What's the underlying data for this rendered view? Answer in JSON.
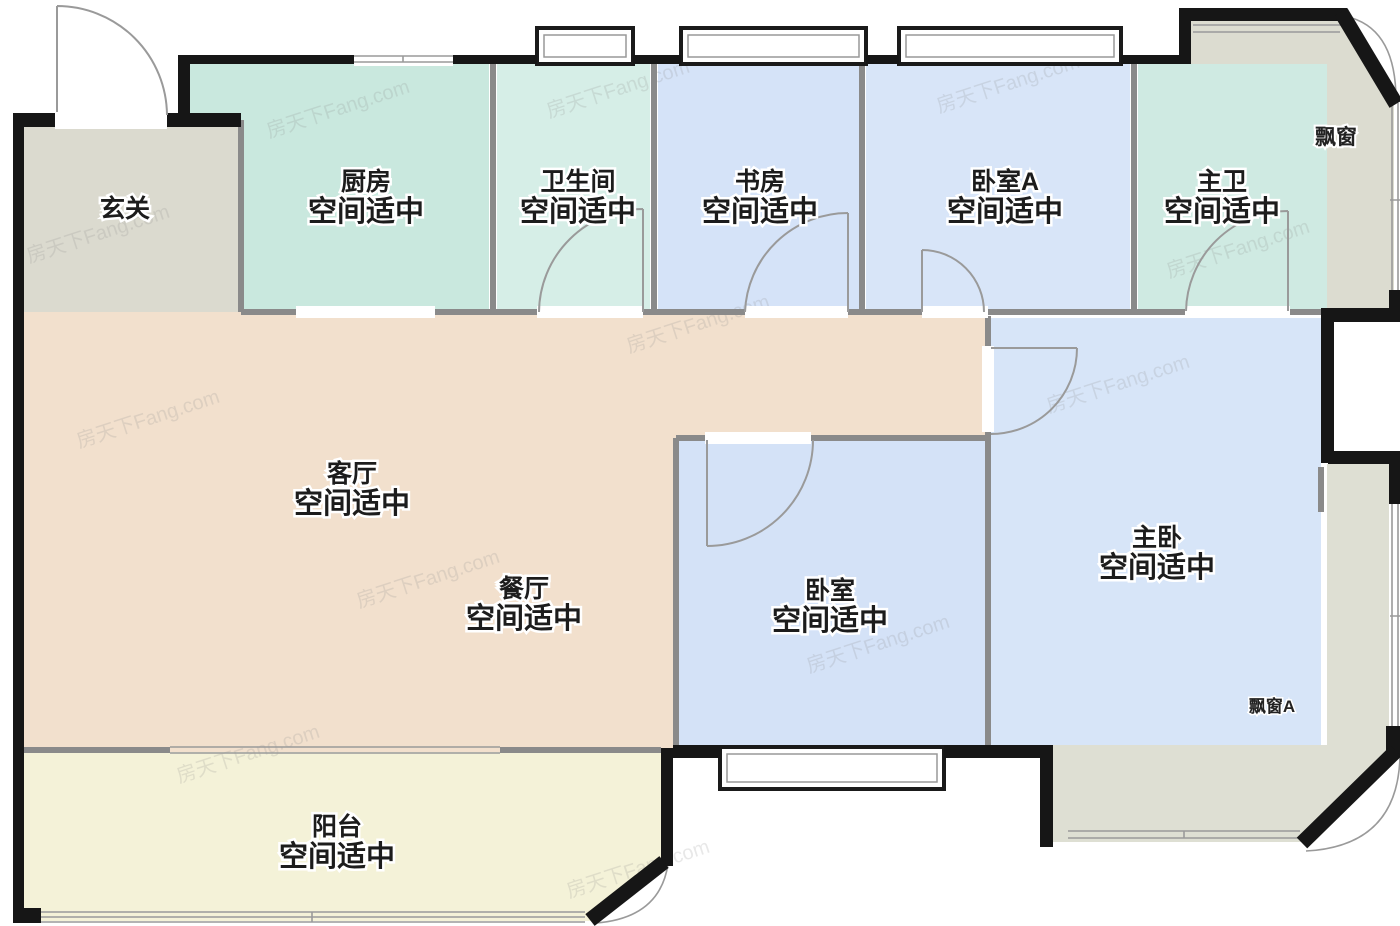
{
  "watermark": {
    "text": "房天下Fang.com"
  },
  "plan": {
    "size_note_text": "空间适中",
    "rooms": [
      {
        "key": "foyer",
        "name": "玄关",
        "size_note": "",
        "color": "#dbdacf"
      },
      {
        "key": "kitchen",
        "name": "厨房",
        "size_note": "空间适中",
        "color": "#c9e8de"
      },
      {
        "key": "bathroom",
        "name": "卫生间",
        "size_note": "空间适中",
        "color": "#d6eee7"
      },
      {
        "key": "study",
        "name": "书房",
        "size_note": "空间适中",
        "color": "#d5e3f8"
      },
      {
        "key": "bedroom-a",
        "name": "卧室A",
        "size_note": "空间适中",
        "color": "#d8e5f8"
      },
      {
        "key": "master-bath",
        "name": "主卫",
        "size_note": "空间适中",
        "color": "#cfeae2"
      },
      {
        "key": "living-room",
        "name": "客厅",
        "size_note": "空间适中",
        "color": "#f2e0cd"
      },
      {
        "key": "dining-room",
        "name": "餐厅",
        "size_note": "空间适中"
      },
      {
        "key": "bedroom",
        "name": "卧室",
        "size_note": "空间适中",
        "color": "#d4e2f7"
      },
      {
        "key": "master-bedroom",
        "name": "主卧",
        "size_note": "空间适中",
        "color": "#d7e5f8"
      },
      {
        "key": "balcony",
        "name": "阳台",
        "size_note": "空间适中",
        "color": "#f4f2d8"
      },
      {
        "key": "bay-window",
        "name": "飘窗",
        "size_note": "",
        "color": "#dcdcd0"
      },
      {
        "key": "bay-window-a",
        "name": "飘窗A",
        "size_note": "",
        "color": "#dedfd3"
      }
    ],
    "walls": {
      "outer_color": "#161616",
      "partition_color": "#8a8a8a",
      "door_color": "#9a9a9a",
      "window_color": "#9a9a9a"
    }
  }
}
